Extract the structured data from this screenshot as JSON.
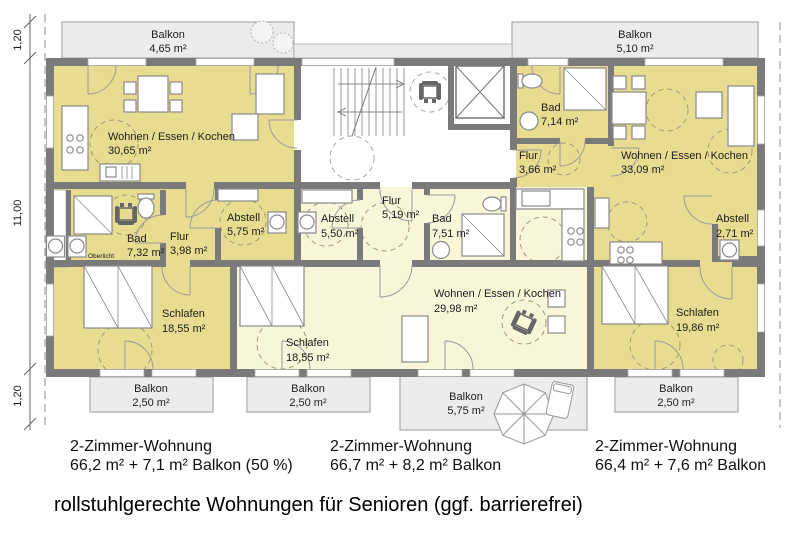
{
  "plan": {
    "caption": "rollstuhlgerechte Wohnungen für Senioren (ggf. barrierefrei)",
    "dimensions": {
      "top": "1,20",
      "middle": "11,00",
      "bottom": "1,20"
    },
    "balconies": {
      "top_left": {
        "label": "Balkon",
        "area": "4,65 m²"
      },
      "top_right": {
        "label": "Balkon",
        "area": "5,10 m²"
      },
      "bottom_left": {
        "label": "Balkon",
        "area": "2,50 m²"
      },
      "bottom_mid_left": {
        "label": "Balkon",
        "area": "2,50 m²"
      },
      "bottom_mid_right": {
        "label": "Balkon",
        "area": "5,75 m²"
      },
      "bottom_right": {
        "label": "Balkon",
        "area": "2,50 m²"
      }
    },
    "left": {
      "wohnen": {
        "label": "Wohnen / Essen / Kochen",
        "area": "30,65 m²"
      },
      "bad": {
        "label": "Bad",
        "area": "7,32 m²"
      },
      "flur": {
        "label": "Flur",
        "area": "3,98 m²"
      },
      "abstell": {
        "label": "Abstell",
        "area": "5,75 m²"
      },
      "schlafen": {
        "label": "Schlafen",
        "area": "18,55 m²"
      },
      "oberlicht": "Oberlicht"
    },
    "middle": {
      "abstell": {
        "label": "Abstell",
        "area": "5,50 m²"
      },
      "flur": {
        "label": "Flur",
        "area": "5,19 m²"
      },
      "bad": {
        "label": "Bad",
        "area": "7,51 m²"
      },
      "schlafen": {
        "label": "Schlafen",
        "area": "18,55 m²"
      },
      "wohnen": {
        "label": "Wohnen / Essen / Kochen",
        "area": "29,98 m²"
      }
    },
    "right": {
      "bad": {
        "label": "Bad",
        "area": "7,14 m²"
      },
      "flur": {
        "label": "Flur",
        "area": "3,66 m²"
      },
      "wohnen": {
        "label": "Wohnen / Essen / Kochen",
        "area": "33,09 m²"
      },
      "abstell": {
        "label": "Abstell",
        "area": "2,71 m²"
      },
      "schlafen": {
        "label": "Schlafen",
        "area": "19,86 m²"
      }
    },
    "units": [
      {
        "title": "2-Zimmer-Wohnung",
        "detail": "66,2 m² + 7,1 m² Balkon (50 %)"
      },
      {
        "title": "2-Zimmer-Wohnung",
        "detail": "66,7 m² + 8,2 m² Balkon"
      },
      {
        "title": "2-Zimmer-Wohnung",
        "detail": "66,4 m² + 7,6 m² Balkon"
      }
    ],
    "colors": {
      "apartment_accent": "#e8dc91",
      "apartment_light": "#f8f6d9",
      "wall": "#7a7a7a",
      "balcony_fill": "#ececec"
    }
  }
}
